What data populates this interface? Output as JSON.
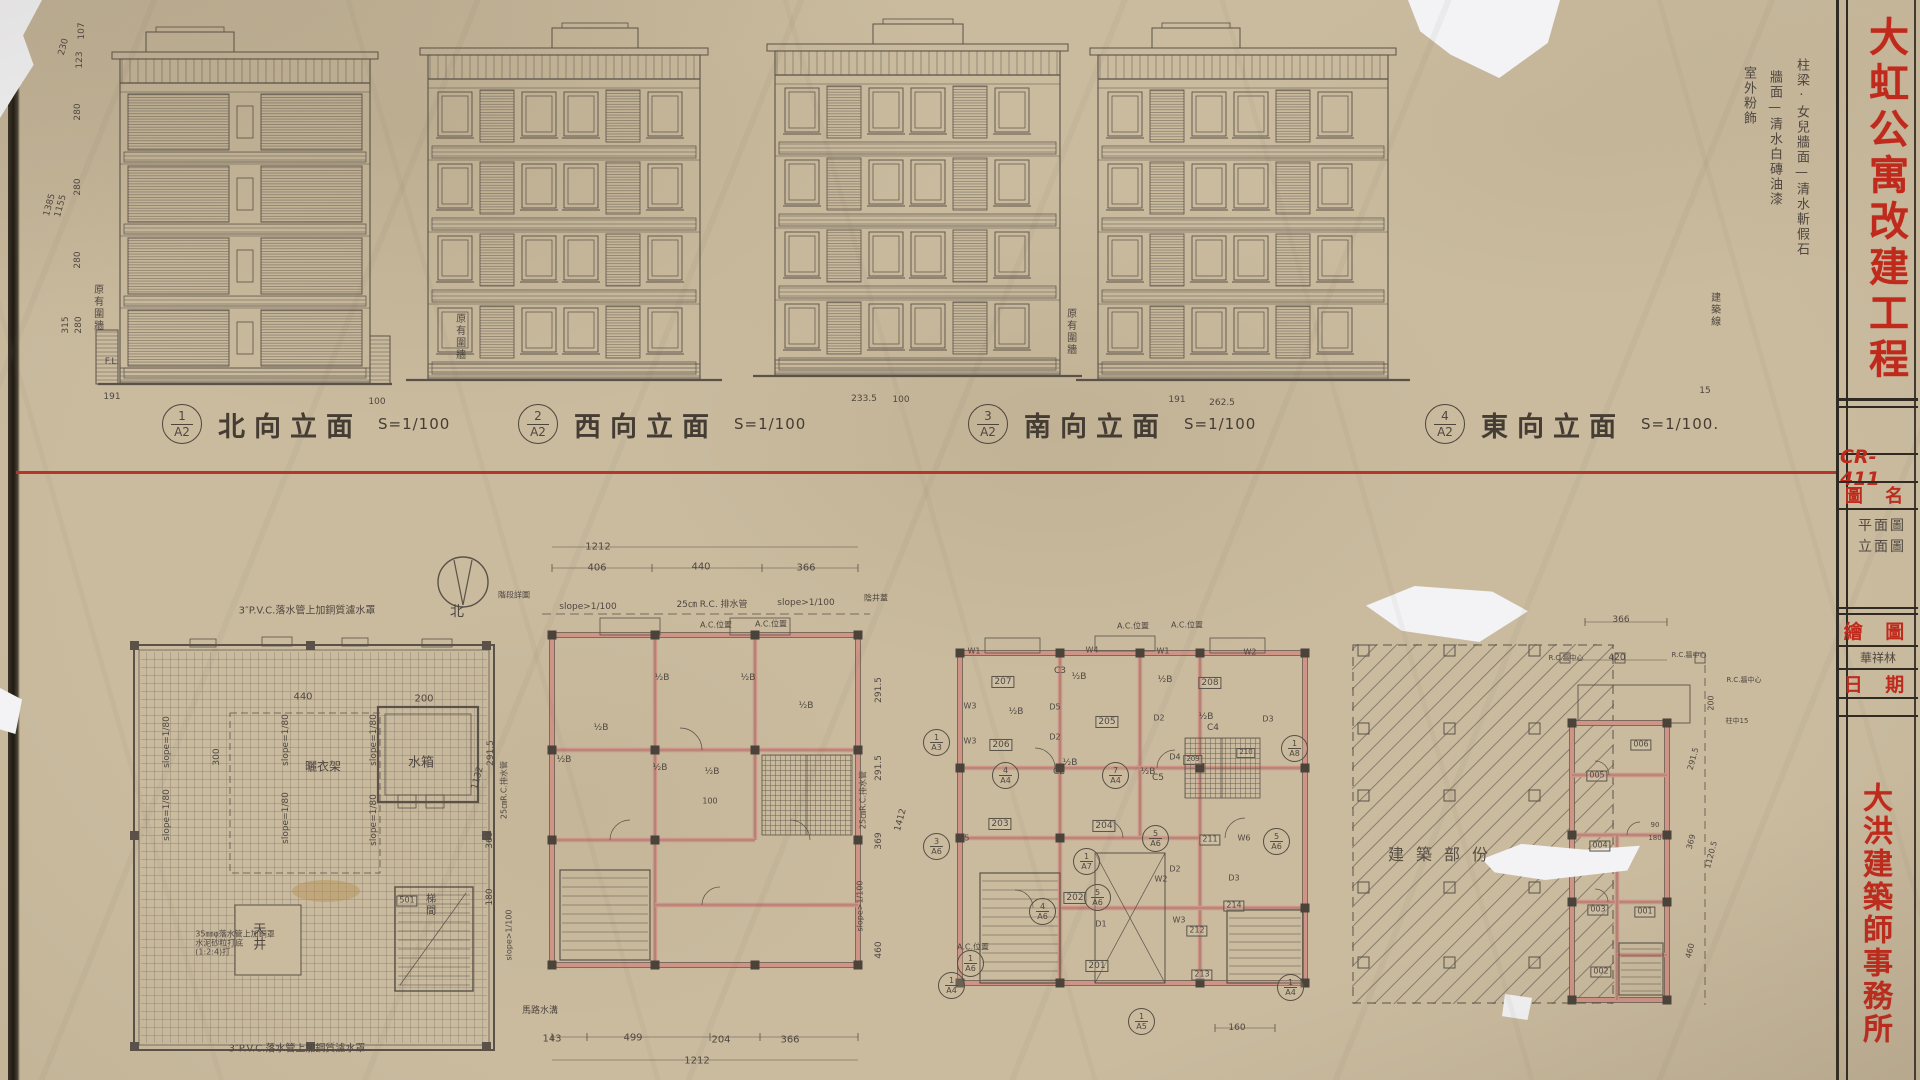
{
  "colors": {
    "paper": "#cabb9f",
    "pencil_line": "#5a5248",
    "red_divider": "#b5352a",
    "red_stamp_text": "#c02a1c",
    "wall_pink": "#cf9486"
  },
  "title_block": {
    "drawing_no": "CR-411",
    "project_title": "大虹公寓改建工程",
    "firm_name": "大洪建築師事務所",
    "drawing_name_label": "圖 名",
    "drawing_name_line1": "平面圖",
    "drawing_name_line2": "立面圖",
    "drawn_by_label": "繪 圖",
    "drawn_by_value": "華祥林",
    "date_label": "日 期"
  },
  "finish_notes": {
    "note1": "柱梁·女兒牆面—清水斬假石",
    "note2": "牆面—清水白磚油漆",
    "note3": "室外粉飾"
  },
  "elevations": [
    {
      "no": "1",
      "sheet": "A2",
      "title": "北向立面",
      "scale": "S=1/100"
    },
    {
      "no": "2",
      "sheet": "A2",
      "title": "西向立面",
      "scale": "S=1/100"
    },
    {
      "no": "3",
      "sheet": "A2",
      "title": "南向立面",
      "scale": "S=1/100"
    },
    {
      "no": "4",
      "sheet": "A2",
      "title": "東向立面",
      "scale": "S=1/100."
    }
  ],
  "annotations": [
    {
      "n": "dim-left",
      "t": "107",
      "x": 82,
      "y": 31,
      "fs": 9,
      "rot": -90
    },
    {
      "n": "dim-left",
      "t": "230",
      "x": 64,
      "y": 47,
      "fs": 9,
      "rot": -75
    },
    {
      "n": "dim-left",
      "t": "123",
      "x": 80,
      "y": 60,
      "fs": 9,
      "rot": -90
    },
    {
      "n": "dim-left",
      "t": "280",
      "x": 78,
      "y": 112,
      "fs": 9,
      "rot": -90
    },
    {
      "n": "dim-left",
      "t": "280",
      "x": 78,
      "y": 187,
      "fs": 9,
      "rot": -90
    },
    {
      "n": "dim-left",
      "t": "1385",
      "x": 50,
      "y": 205,
      "fs": 9,
      "rot": -75
    },
    {
      "n": "dim-left",
      "t": "1155",
      "x": 61,
      "y": 206,
      "fs": 9,
      "rot": -75
    },
    {
      "n": "dim-left",
      "t": "280",
      "x": 78,
      "y": 260,
      "fs": 9,
      "rot": -90
    },
    {
      "n": "dim-left",
      "t": "315",
      "x": 66,
      "y": 325,
      "fs": 9,
      "rot": -90
    },
    {
      "n": "dim-left",
      "t": "280",
      "x": 79,
      "y": 325,
      "fs": 9,
      "rot": -90
    },
    {
      "n": "level-label",
      "t": "F.L.",
      "x": 112,
      "y": 362,
      "fs": 9
    },
    {
      "n": "note-existing-wall",
      "t": "原有圍牆",
      "x": 97,
      "y": 308,
      "fs": 10,
      "cls": "v"
    },
    {
      "n": "dim-under-elev",
      "t": "191",
      "x": 112,
      "y": 397,
      "fs": 9
    },
    {
      "n": "dim-under-elev",
      "t": "100",
      "x": 377,
      "y": 402,
      "fs": 9
    },
    {
      "n": "dim-under-elev",
      "t": "233.5",
      "x": 864,
      "y": 399,
      "fs": 9
    },
    {
      "n": "dim-under-elev",
      "t": "100",
      "x": 901,
      "y": 400,
      "fs": 9
    },
    {
      "n": "dim-under-elev",
      "t": "191",
      "x": 1177,
      "y": 400,
      "fs": 9
    },
    {
      "n": "dim-under-elev",
      "t": "262.5",
      "x": 1222,
      "y": 403,
      "fs": 9
    },
    {
      "n": "dim-under-elev",
      "t": "15",
      "x": 1705,
      "y": 391,
      "fs": 9
    },
    {
      "n": "note-existing-wall",
      "t": "原有圍牆",
      "x": 459,
      "y": 337,
      "fs": 10,
      "cls": "v"
    },
    {
      "n": "note-existing-wall",
      "t": "原有圍牆",
      "x": 1070,
      "y": 332,
      "fs": 10,
      "cls": "v"
    },
    {
      "n": "note-building-line",
      "t": "建築線",
      "x": 1714,
      "y": 310,
      "fs": 10,
      "cls": "v"
    },
    {
      "n": "roof-note",
      "t": "3″P.V.C.落水管上加銅質濾水罩",
      "x": 307,
      "y": 611,
      "fs": 10
    },
    {
      "n": "roof-dim",
      "t": "440",
      "x": 303,
      "y": 697,
      "fs": 10
    },
    {
      "n": "roof-dim",
      "t": "200",
      "x": 424,
      "y": 699,
      "fs": 10
    },
    {
      "n": "roof-dim",
      "t": "300",
      "x": 217,
      "y": 757,
      "fs": 9,
      "rot": -90
    },
    {
      "n": "slope-label",
      "t": "slope=1/80",
      "x": 167,
      "y": 742,
      "fs": 9,
      "rot": -90
    },
    {
      "n": "slope-label",
      "t": "slope=1/80",
      "x": 286,
      "y": 740,
      "fs": 9,
      "rot": -90
    },
    {
      "n": "slope-label",
      "t": "slope=1/80",
      "x": 374,
      "y": 740,
      "fs": 9,
      "rot": -90
    },
    {
      "n": "slope-label",
      "t": "slope=1/80",
      "x": 167,
      "y": 815,
      "fs": 9,
      "rot": -90
    },
    {
      "n": "slope-label",
      "t": "slope=1/80",
      "x": 286,
      "y": 818,
      "fs": 9,
      "rot": -90
    },
    {
      "n": "slope-label",
      "t": "slope=1/80",
      "x": 374,
      "y": 820,
      "fs": 9,
      "rot": -90
    },
    {
      "n": "room-label",
      "t": "曬衣架",
      "x": 323,
      "y": 767,
      "fs": 12
    },
    {
      "n": "room-label",
      "t": "水箱",
      "x": 421,
      "y": 764,
      "fs": 13
    },
    {
      "n": "room-label",
      "t": "天井",
      "x": 257,
      "y": 937,
      "fs": 13,
      "cls": "v"
    },
    {
      "n": "room-label",
      "t": "501",
      "x": 407,
      "y": 901,
      "fs": 8,
      "cls": "bx"
    },
    {
      "n": "room-label",
      "t": "梯間",
      "x": 429,
      "y": 905,
      "fs": 10,
      "cls": "v"
    },
    {
      "n": "roof-note",
      "t": "35㎜φ落水管上加銅罩\n水泥砂粒打底\n(1:2:4)打",
      "x": 235,
      "y": 944,
      "fs": 8
    },
    {
      "n": "roof-note",
      "t": "3″P.V.C.落水管上加鋼質濾水罩",
      "x": 297,
      "y": 1049,
      "fs": 10
    },
    {
      "n": "dim-chain",
      "t": "291.5",
      "x": 491,
      "y": 753,
      "fs": 9,
      "rot": -90
    },
    {
      "n": "dim-chain",
      "t": "1132",
      "x": 478,
      "y": 778,
      "fs": 9,
      "rot": -75
    },
    {
      "n": "drain-note",
      "t": "25㎝R.C.排水管",
      "x": 505,
      "y": 790,
      "fs": 8,
      "rot": -90
    },
    {
      "n": "dim-chain",
      "t": "369",
      "x": 490,
      "y": 840,
      "fs": 9,
      "rot": -90
    },
    {
      "n": "dim-chain",
      "t": "180",
      "x": 490,
      "y": 897,
      "fs": 9,
      "rot": -90
    },
    {
      "n": "slope-label",
      "t": "slope>1/100",
      "x": 510,
      "y": 935,
      "fs": 8,
      "rot": -90
    },
    {
      "n": "dim-plan2",
      "t": "1212",
      "x": 598,
      "y": 547,
      "fs": 10
    },
    {
      "n": "dim-plan2",
      "t": "406",
      "x": 597,
      "y": 568,
      "fs": 10
    },
    {
      "n": "dim-plan2",
      "t": "440",
      "x": 701,
      "y": 567,
      "fs": 10
    },
    {
      "n": "dim-plan2",
      "t": "366",
      "x": 806,
      "y": 568,
      "fs": 10
    },
    {
      "n": "slope-label",
      "t": "slope>1/100",
      "x": 588,
      "y": 607,
      "fs": 9
    },
    {
      "n": "drain-note",
      "t": "25㎝ R.C. 排水管",
      "x": 712,
      "y": 605,
      "fs": 9
    },
    {
      "n": "slope-label",
      "t": "slope>1/100",
      "x": 806,
      "y": 603,
      "fs": 9
    },
    {
      "n": "ac-label",
      "t": "A.C.位置",
      "x": 716,
      "y": 626,
      "fs": 8
    },
    {
      "n": "ac-label",
      "t": "A.C.位置",
      "x": 771,
      "y": 625,
      "fs": 8
    },
    {
      "n": "north-label",
      "t": "北",
      "x": 457,
      "y": 613,
      "fs": 14
    },
    {
      "n": "detail-note",
      "t": "階段詳圖",
      "x": 514,
      "y": 596,
      "fs": 8
    },
    {
      "n": "wall-mark",
      "t": "½B",
      "x": 662,
      "y": 678,
      "fs": 9
    },
    {
      "n": "wall-mark",
      "t": "½B",
      "x": 748,
      "y": 678,
      "fs": 9
    },
    {
      "n": "wall-mark",
      "t": "½B",
      "x": 601,
      "y": 728,
      "fs": 9
    },
    {
      "n": "wall-mark",
      "t": "½B",
      "x": 564,
      "y": 760,
      "fs": 9
    },
    {
      "n": "wall-mark",
      "t": "½B",
      "x": 660,
      "y": 768,
      "fs": 9
    },
    {
      "n": "wall-mark",
      "t": "½B",
      "x": 712,
      "y": 772,
      "fs": 9
    },
    {
      "n": "wall-mark",
      "t": "½B",
      "x": 806,
      "y": 706,
      "fs": 9
    },
    {
      "n": "dim-plan2",
      "t": "100",
      "x": 710,
      "y": 802,
      "fs": 8
    },
    {
      "n": "gutter-note",
      "t": "馬路水溝",
      "x": 540,
      "y": 1011,
      "fs": 9
    },
    {
      "n": "dim-plan2",
      "t": "143",
      "x": 552,
      "y": 1039,
      "fs": 10
    },
    {
      "n": "dim-plan2",
      "t": "499",
      "x": 633,
      "y": 1038,
      "fs": 10
    },
    {
      "n": "dim-plan2",
      "t": "204",
      "x": 721,
      "y": 1040,
      "fs": 10
    },
    {
      "n": "dim-plan2",
      "t": "366",
      "x": 790,
      "y": 1040,
      "fs": 10
    },
    {
      "n": "dim-plan2",
      "t": "1212",
      "x": 697,
      "y": 1061,
      "fs": 10
    },
    {
      "n": "dim-chain",
      "t": "291.5",
      "x": 879,
      "y": 690,
      "fs": 9,
      "rot": -90
    },
    {
      "n": "dim-chain",
      "t": "291.5",
      "x": 879,
      "y": 768,
      "fs": 9,
      "rot": -90
    },
    {
      "n": "dim-chain",
      "t": "369",
      "x": 879,
      "y": 841,
      "fs": 9,
      "rot": -90
    },
    {
      "n": "dim-chain",
      "t": "460",
      "x": 879,
      "y": 950,
      "fs": 9,
      "rot": -90
    },
    {
      "n": "dim-chain",
      "t": "1412",
      "x": 901,
      "y": 820,
      "fs": 9,
      "rot": -75
    },
    {
      "n": "drain-note",
      "t": "25㎝R.C.排水管",
      "x": 864,
      "y": 800,
      "fs": 8,
      "rot": -90
    },
    {
      "n": "slope-label",
      "t": "slope>1/100",
      "x": 861,
      "y": 906,
      "fs": 8,
      "rot": -90
    },
    {
      "n": "drain-note",
      "t": "陰井蓋",
      "x": 876,
      "y": 599,
      "fs": 8
    },
    {
      "n": "ac-label",
      "t": "A.C.位置",
      "x": 1133,
      "y": 627,
      "fs": 8
    },
    {
      "n": "ac-label",
      "t": "A.C.位置",
      "x": 1187,
      "y": 626,
      "fs": 8
    },
    {
      "n": "window-label",
      "t": "W1",
      "x": 974,
      "y": 652,
      "fs": 8
    },
    {
      "n": "window-label",
      "t": "W4",
      "x": 1092,
      "y": 651,
      "fs": 8
    },
    {
      "n": "window-label",
      "t": "W1",
      "x": 1163,
      "y": 652,
      "fs": 8
    },
    {
      "n": "window-label",
      "t": "W2",
      "x": 1250,
      "y": 653,
      "fs": 8
    },
    {
      "n": "window-label",
      "t": "W3",
      "x": 970,
      "y": 707,
      "fs": 8
    },
    {
      "n": "window-label",
      "t": "W3",
      "x": 970,
      "y": 742,
      "fs": 8
    },
    {
      "n": "window-label",
      "t": "W5",
      "x": 963,
      "y": 839,
      "fs": 8
    },
    {
      "n": "window-label",
      "t": "W2",
      "x": 1161,
      "y": 880,
      "fs": 8
    },
    {
      "n": "window-label",
      "t": "W3",
      "x": 1179,
      "y": 921,
      "fs": 8
    },
    {
      "n": "window-label",
      "t": "W6",
      "x": 1244,
      "y": 839,
      "fs": 8
    },
    {
      "n": "door-label",
      "t": "D1",
      "x": 1101,
      "y": 925,
      "fs": 8
    },
    {
      "n": "door-label",
      "t": "D2",
      "x": 1175,
      "y": 870,
      "fs": 8
    },
    {
      "n": "door-label",
      "t": "D2",
      "x": 1159,
      "y": 719,
      "fs": 8
    },
    {
      "n": "door-label",
      "t": "D3",
      "x": 1268,
      "y": 720,
      "fs": 8
    },
    {
      "n": "door-label",
      "t": "D3",
      "x": 1234,
      "y": 879,
      "fs": 8
    },
    {
      "n": "door-label",
      "t": "D4",
      "x": 1175,
      "y": 758,
      "fs": 8
    },
    {
      "n": "door-label",
      "t": "D5",
      "x": 1055,
      "y": 708,
      "fs": 8
    },
    {
      "n": "door-label",
      "t": "D2",
      "x": 1055,
      "y": 738,
      "fs": 8
    },
    {
      "n": "closet-label",
      "t": "C3",
      "x": 1060,
      "y": 671,
      "fs": 9
    },
    {
      "n": "closet-label",
      "t": "C4",
      "x": 1213,
      "y": 728,
      "fs": 9
    },
    {
      "n": "closet-label",
      "t": "C2",
      "x": 1059,
      "y": 772,
      "fs": 9
    },
    {
      "n": "closet-label",
      "t": "C5",
      "x": 1158,
      "y": 778,
      "fs": 9
    },
    {
      "n": "wall-mark",
      "t": "½B",
      "x": 1079,
      "y": 677,
      "fs": 9
    },
    {
      "n": "wall-mark",
      "t": "½B",
      "x": 1165,
      "y": 680,
      "fs": 9
    },
    {
      "n": "wall-mark",
      "t": "½B",
      "x": 1206,
      "y": 717,
      "fs": 9
    },
    {
      "n": "wall-mark",
      "t": "½B",
      "x": 1070,
      "y": 763,
      "fs": 9
    },
    {
      "n": "wall-mark",
      "t": "½B",
      "x": 1148,
      "y": 772,
      "fs": 9
    },
    {
      "n": "wall-mark",
      "t": "½B",
      "x": 1016,
      "y": 712,
      "fs": 9
    },
    {
      "n": "ac-label",
      "t": "A.C.位置",
      "x": 973,
      "y": 948,
      "fs": 8
    },
    {
      "n": "room-number",
      "t": "207",
      "x": 1003,
      "y": 682,
      "fs": 9,
      "cls": "bx"
    },
    {
      "n": "room-number",
      "t": "206",
      "x": 1001,
      "y": 745,
      "fs": 9,
      "cls": "bx"
    },
    {
      "n": "room-number",
      "t": "205",
      "x": 1107,
      "y": 722,
      "fs": 9,
      "cls": "bx"
    },
    {
      "n": "room-number",
      "t": "208",
      "x": 1210,
      "y": 683,
      "fs": 9,
      "cls": "bx"
    },
    {
      "n": "room-number",
      "t": "209",
      "x": 1193,
      "y": 760,
      "fs": 7,
      "cls": "bx"
    },
    {
      "n": "room-number",
      "t": "210",
      "x": 1246,
      "y": 753,
      "fs": 7,
      "cls": "bx"
    },
    {
      "n": "room-number",
      "t": "203",
      "x": 1000,
      "y": 824,
      "fs": 9,
      "cls": "bx"
    },
    {
      "n": "room-number",
      "t": "204",
      "x": 1104,
      "y": 826,
      "fs": 9,
      "cls": "bx"
    },
    {
      "n": "room-number",
      "t": "202",
      "x": 1075,
      "y": 898,
      "fs": 9,
      "cls": "bx"
    },
    {
      "n": "room-number",
      "t": "201",
      "x": 1097,
      "y": 966,
      "fs": 9,
      "cls": "bx"
    },
    {
      "n": "room-number",
      "t": "211",
      "x": 1210,
      "y": 840,
      "fs": 8,
      "cls": "bx"
    },
    {
      "n": "room-number",
      "t": "212",
      "x": 1197,
      "y": 931,
      "fs": 8,
      "cls": "bx"
    },
    {
      "n": "room-number",
      "t": "213",
      "x": 1202,
      "y": 975,
      "fs": 8,
      "cls": "bx"
    },
    {
      "n": "room-number",
      "t": "214",
      "x": 1234,
      "y": 906,
      "fs": 8,
      "cls": "bx"
    },
    {
      "n": "dim-plan3",
      "t": "160",
      "x": 1237,
      "y": 1028,
      "fs": 9
    },
    {
      "n": "ref-marker",
      "top": "1",
      "bot": "A3",
      "x": 936,
      "y": 742
    },
    {
      "n": "ref-marker",
      "top": "3",
      "bot": "A6",
      "x": 936,
      "y": 846
    },
    {
      "n": "ref-marker",
      "top": "1",
      "bot": "A4",
      "x": 951,
      "y": 985
    },
    {
      "n": "ref-marker",
      "top": "1",
      "bot": "A4",
      "x": 1290,
      "y": 987
    },
    {
      "n": "ref-marker",
      "top": "1",
      "bot": "A8",
      "x": 1294,
      "y": 748
    },
    {
      "n": "ref-marker",
      "top": "4",
      "bot": "A6",
      "x": 1042,
      "y": 911
    },
    {
      "n": "ref-marker",
      "top": "5",
      "bot": "A6",
      "x": 1097,
      "y": 897
    },
    {
      "n": "ref-marker",
      "top": "5",
      "bot": "A6",
      "x": 1155,
      "y": 838
    },
    {
      "n": "ref-marker",
      "top": "5",
      "bot": "A6",
      "x": 1276,
      "y": 841
    },
    {
      "n": "ref-marker",
      "top": "1",
      "bot": "A5",
      "x": 1141,
      "y": 1021
    },
    {
      "n": "ref-marker",
      "top": "1",
      "bot": "A7",
      "x": 1086,
      "y": 861
    },
    {
      "n": "ref-marker",
      "top": "4",
      "bot": "A4",
      "x": 1005,
      "y": 775
    },
    {
      "n": "ref-marker",
      "top": "7",
      "bot": "A4",
      "x": 1115,
      "y": 775
    },
    {
      "n": "ref-marker",
      "top": "1",
      "bot": "A6",
      "x": 970,
      "y": 963
    },
    {
      "n": "area-label",
      "t": "建築部份",
      "x": 1444,
      "y": 855,
      "fs": 16,
      "cls": "sp"
    },
    {
      "n": "dim-plan5",
      "t": "366",
      "x": 1621,
      "y": 620,
      "fs": 9
    },
    {
      "n": "rc-note",
      "t": "R.C.牆中心",
      "x": 1566,
      "y": 659,
      "fs": 7
    },
    {
      "n": "dim-plan5",
      "t": "420",
      "x": 1617,
      "y": 658,
      "fs": 9
    },
    {
      "n": "rc-note",
      "t": "R.C.牆中心",
      "x": 1689,
      "y": 656,
      "fs": 7
    },
    {
      "n": "rc-note",
      "t": "R.C.牆中心",
      "x": 1744,
      "y": 681,
      "fs": 7
    },
    {
      "n": "dim-plan5",
      "t": "200",
      "x": 1712,
      "y": 703,
      "fs": 8,
      "rot": -90
    },
    {
      "n": "rc-note",
      "t": "柱中15",
      "x": 1737,
      "y": 722,
      "fs": 7
    },
    {
      "n": "dim-plan5",
      "t": "291.5",
      "x": 1694,
      "y": 759,
      "fs": 8,
      "rot": -75
    },
    {
      "n": "dim-plan5",
      "t": "369",
      "x": 1692,
      "y": 842,
      "fs": 8,
      "rot": -75
    },
    {
      "n": "dim-plan5",
      "t": "1120.5",
      "x": 1712,
      "y": 855,
      "fs": 8,
      "rot": -75
    },
    {
      "n": "dim-plan5",
      "t": "460",
      "x": 1691,
      "y": 951,
      "fs": 8,
      "rot": -75
    },
    {
      "n": "dim-plan5",
      "t": "90",
      "x": 1655,
      "y": 826,
      "fs": 7
    },
    {
      "n": "dim-plan5",
      "t": "180",
      "x": 1655,
      "y": 839,
      "fs": 7
    },
    {
      "n": "room-number",
      "t": "006",
      "x": 1641,
      "y": 745,
      "fs": 8,
      "cls": "bx"
    },
    {
      "n": "room-number",
      "t": "005",
      "x": 1597,
      "y": 776,
      "fs": 8,
      "cls": "bx"
    },
    {
      "n": "room-number",
      "t": "004",
      "x": 1600,
      "y": 846,
      "fs": 8,
      "cls": "bx"
    },
    {
      "n": "room-number",
      "t": "003",
      "x": 1598,
      "y": 910,
      "fs": 8,
      "cls": "bx"
    },
    {
      "n": "room-number",
      "t": "001",
      "x": 1645,
      "y": 912,
      "fs": 8,
      "cls": "bx"
    },
    {
      "n": "room-number",
      "t": "002",
      "x": 1601,
      "y": 972,
      "fs": 8,
      "cls": "bx"
    }
  ]
}
